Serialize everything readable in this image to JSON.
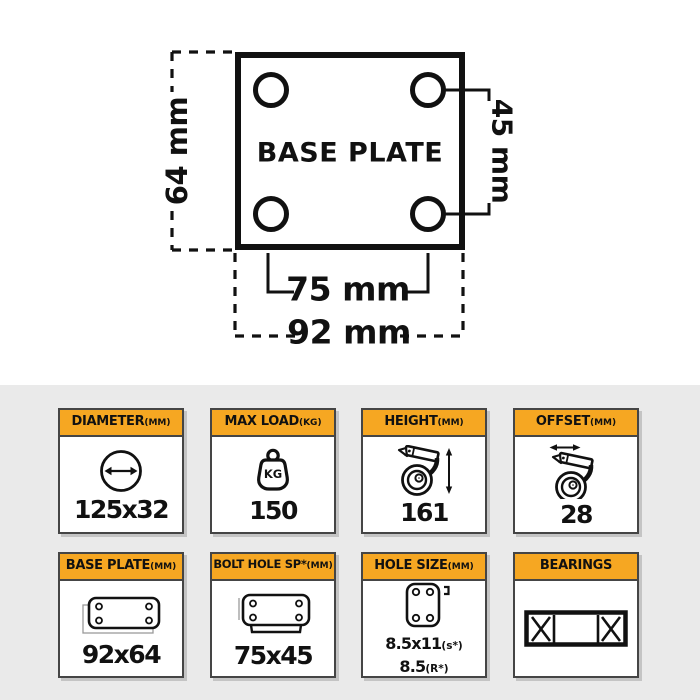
{
  "diagram": {
    "plate_label": "BASE PLATE",
    "overall_height": "64 mm",
    "hole_spacing_vertical": "45 mm",
    "hole_spacing_horizontal": "75 mm",
    "overall_width": "92 mm"
  },
  "colors": {
    "accent": "#F6A722",
    "section_bg": "#EAEAEA",
    "line": "#111111",
    "card_border": "#454545"
  },
  "cards": [
    {
      "label": "DIAMETER",
      "unit": "(MM)",
      "value": "125x32",
      "icon": "diameter-icon"
    },
    {
      "label": "MAX LOAD",
      "unit": "(KG)",
      "value": "150",
      "icon": "max-load-icon",
      "icon_text": "KG"
    },
    {
      "label": "HEIGHT",
      "unit": "(MM)",
      "value": "161",
      "icon": "caster-height-icon"
    },
    {
      "label": "OFFSET",
      "unit": "(MM)",
      "value": "28",
      "icon": "caster-offset-icon"
    },
    {
      "label": "BASE PLATE",
      "unit": "(MM)",
      "value": "92x64",
      "icon": "base-plate-icon"
    },
    {
      "label": "BOLT HOLE SP*",
      "unit": "(MM)",
      "value": "75x45",
      "icon": "bolt-hole-plate-icon"
    },
    {
      "label": "HOLE SIZE",
      "unit": "(MM)",
      "value_lines": [
        {
          "main": "8.5x11",
          "sub": "(s*)"
        },
        {
          "main": "8.5",
          "sub": "(R*)"
        }
      ],
      "icon": "hole-size-plate-icon"
    },
    {
      "label": "BEARINGS",
      "unit": "",
      "icon": "bearing-icon"
    }
  ]
}
